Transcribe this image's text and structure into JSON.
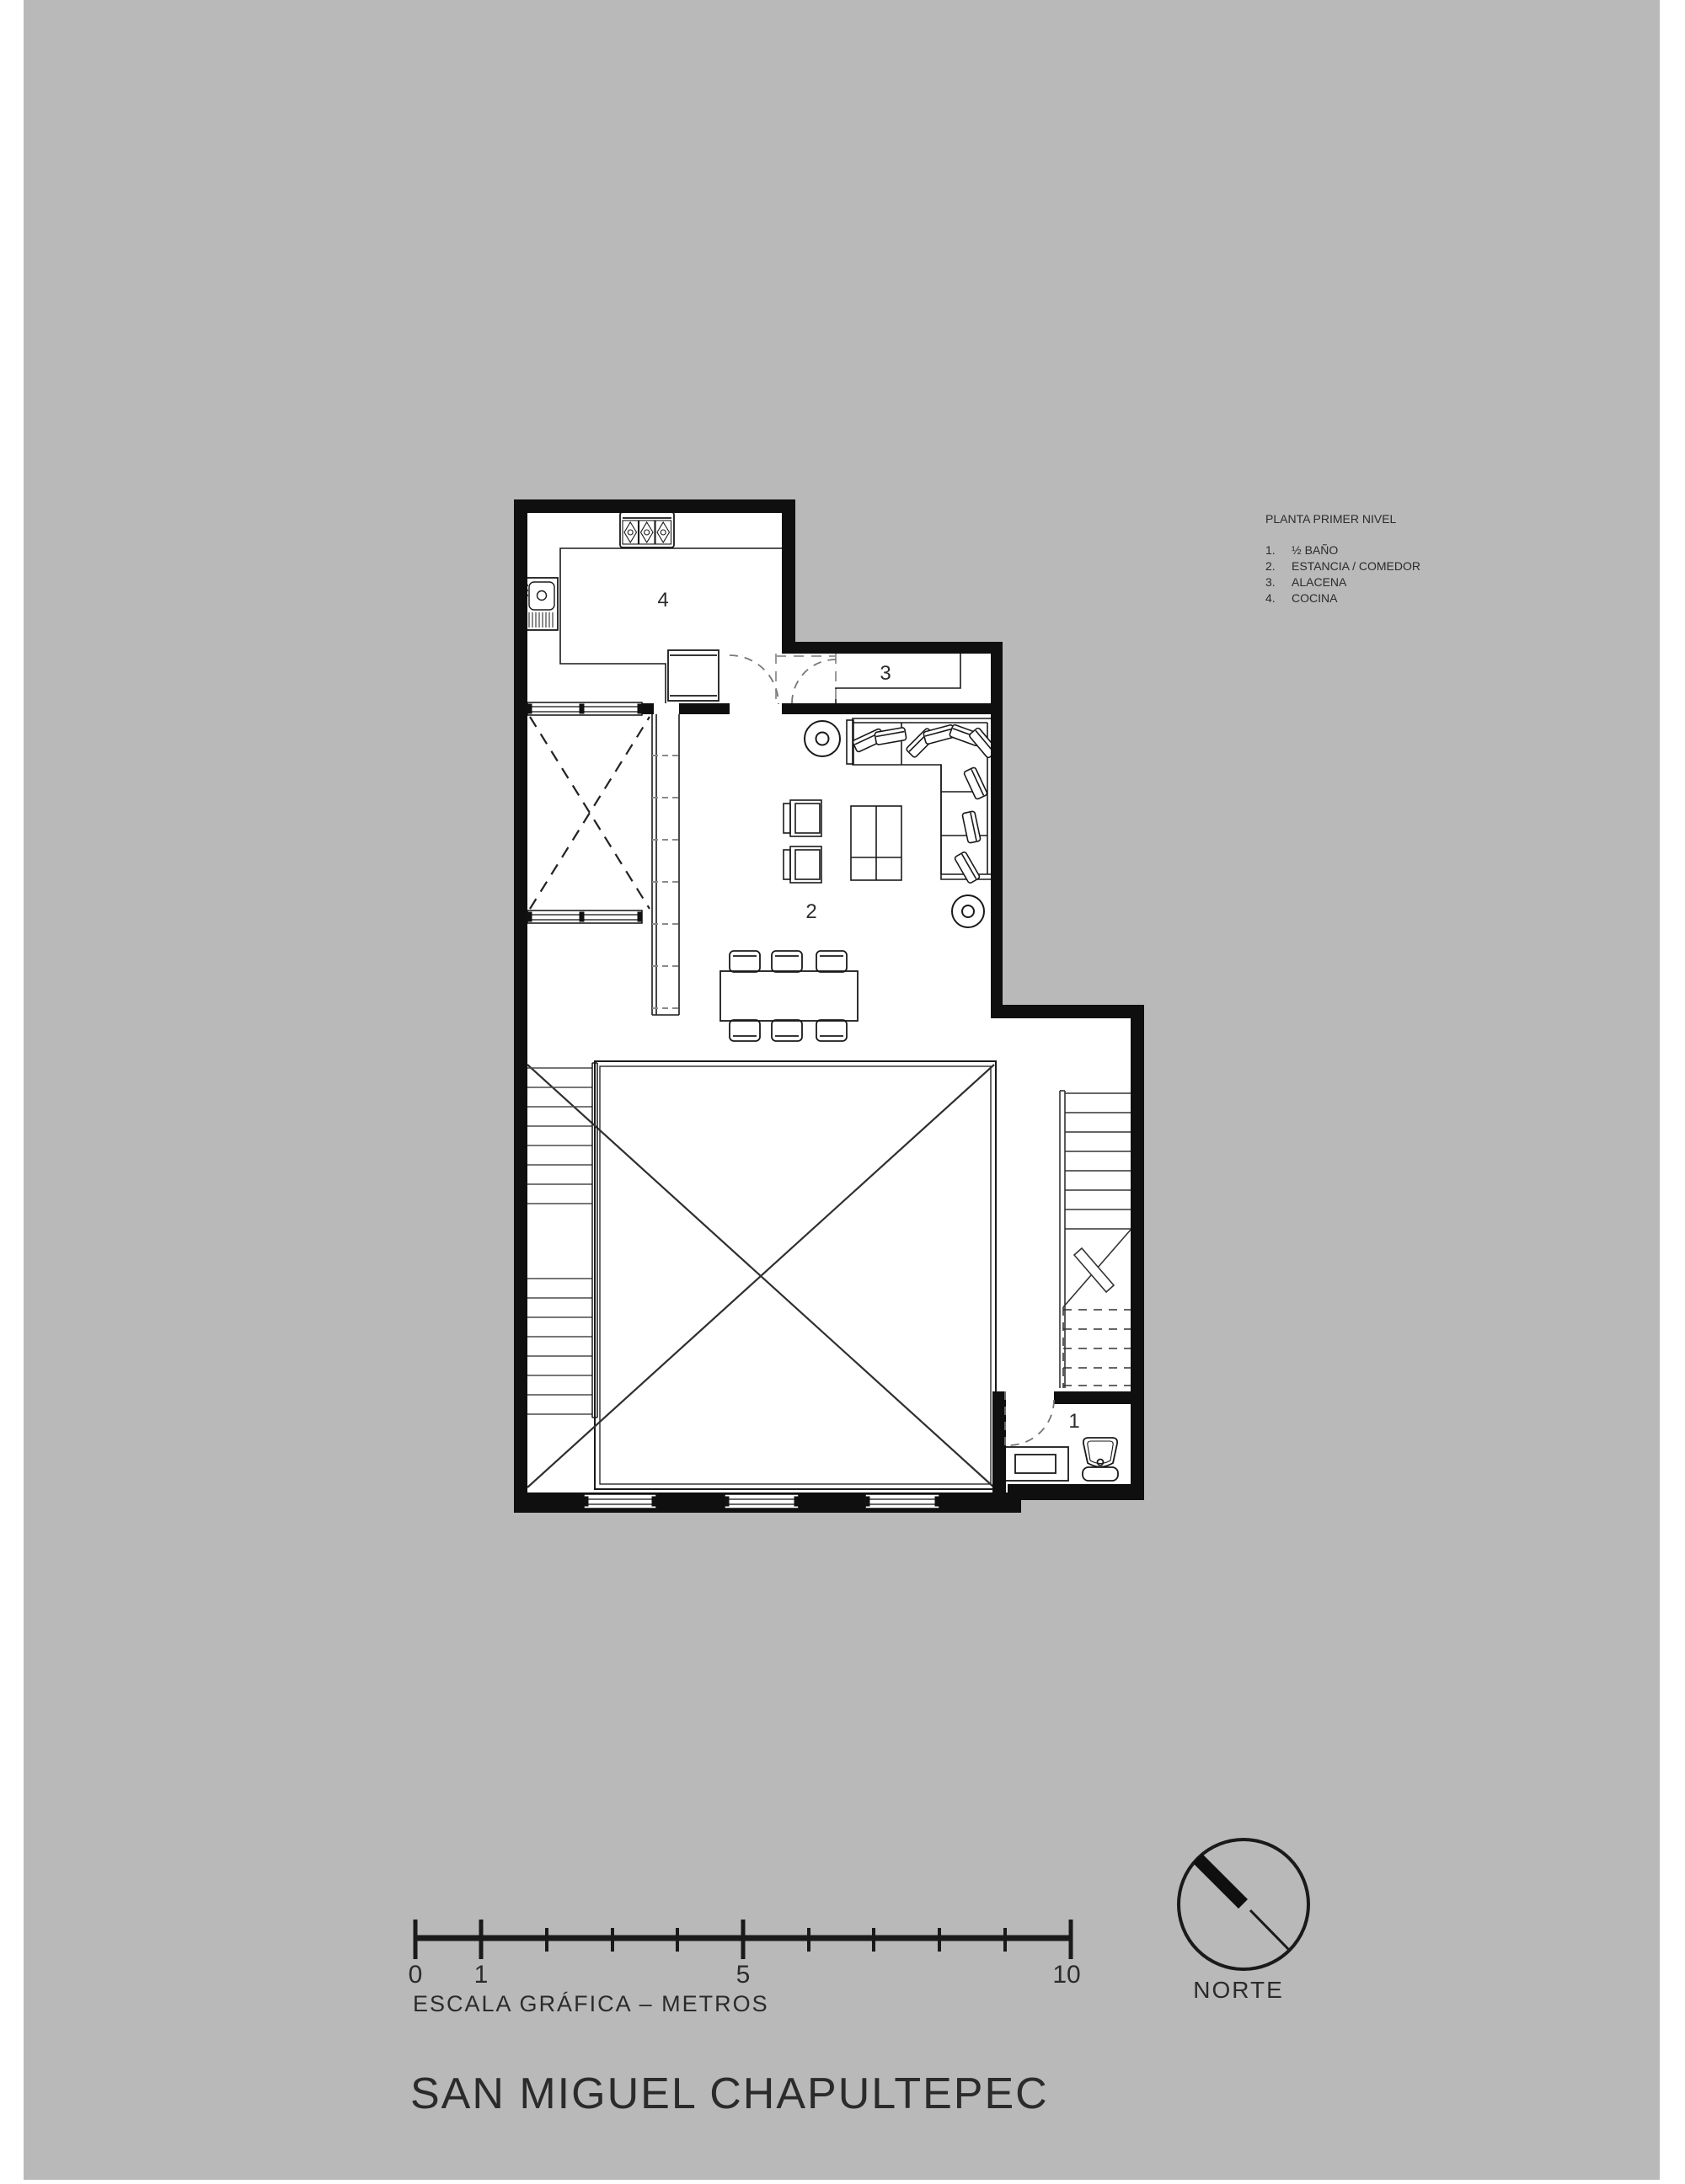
{
  "canvas": {
    "background": "#ffffff",
    "paper_color": "#b9b9b9",
    "ink": "#1a1a1a",
    "wall_color": "#0f0f0f"
  },
  "legend": {
    "title": "PLANTA PRIMER NIVEL",
    "items": [
      {
        "num": "1.",
        "label": "½ BAÑO"
      },
      {
        "num": "2.",
        "label": "ESTANCIA / COMEDOR"
      },
      {
        "num": "3.",
        "label": "ALACENA"
      },
      {
        "num": "4.",
        "label": "COCINA"
      }
    ]
  },
  "plan": {
    "room_labels": {
      "half_bath": "1",
      "estancia_comedor": "2",
      "alacena": "3",
      "cocina": "4"
    }
  },
  "scale_bar": {
    "caption": "ESCALA GRÁFICA – METROS",
    "tick_labels": [
      {
        "label": "0",
        "meters": 0
      },
      {
        "label": "1",
        "meters": 1
      },
      {
        "label": "5",
        "meters": 5
      },
      {
        "label": "10",
        "meters": 10
      }
    ],
    "minor_tick_meters": [
      2,
      3,
      4,
      6,
      7,
      8,
      9
    ],
    "total_meters": 10
  },
  "north": {
    "label": "NORTE"
  },
  "title": {
    "text": "SAN MIGUEL CHAPULTEPEC"
  }
}
